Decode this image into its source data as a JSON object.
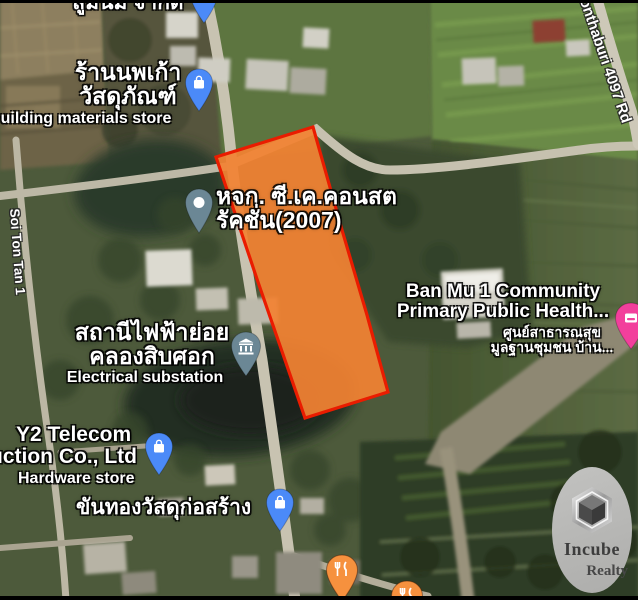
{
  "map": {
    "type": "satellite-map-with-land-parcel-overlay",
    "labels": {
      "company_top": "สูมนม จำกัด",
      "store_th1": "ร้านนพเก้า",
      "store_th2": "วัสดุภัณฑ์",
      "store_en": "uilding materials store",
      "construction1": "หจก. ซี.เค.คอนสต",
      "construction2": "รัคชั่น(2007)",
      "banmu_en1": "Ban Mu 1 Community",
      "banmu_en2": "Primary Public Health...",
      "banmu_th1": "ศูนย์สาธารณสุข",
      "banmu_th2": "มูลฐานชุมชน บ้าน...",
      "substation_th1": "สถานีไฟฟ้าย่อย",
      "substation_th2": "คลองสิบศอก",
      "substation_en": "Electrical substation",
      "y2_line1": "Y2 Telecom",
      "y2_line2": "uction Co., Ltd",
      "y2_line3": "Hardware store",
      "khanthong": "ขันทองวัสดุก่อสร้าง",
      "soi_road": "Soi Ton Tan 1",
      "road_4097": "onthaburi 4097 Rd"
    },
    "icons": {
      "company_pin": "map-pin",
      "store_pin": "shopping-bag",
      "construction_pin": "place-dot",
      "substation_pin": "institution-building",
      "y2_pin": "shopping-bag",
      "khanthong_pin": "shopping-bag",
      "restaurant_pin": "fork-knife",
      "restaurant_pin_2": "fork-knife",
      "lodging_pin": "lodging-card",
      "watermark_logo": "hexagon-cube"
    },
    "colors": {
      "parcel_fill": "#F28233",
      "parcel_border": "#EA1C00",
      "pin_blue": "#4B8AF8",
      "pin_slate": "#6B8795",
      "pin_orange": "#F6913E",
      "pin_pink": "#F23F9C",
      "label_text": "#FFFFFF",
      "watermark_bg": "#B8B8B6",
      "watermark_text": "#3D3D3D"
    }
  },
  "watermark": {
    "brand": "Incube",
    "sub": "Realty"
  }
}
